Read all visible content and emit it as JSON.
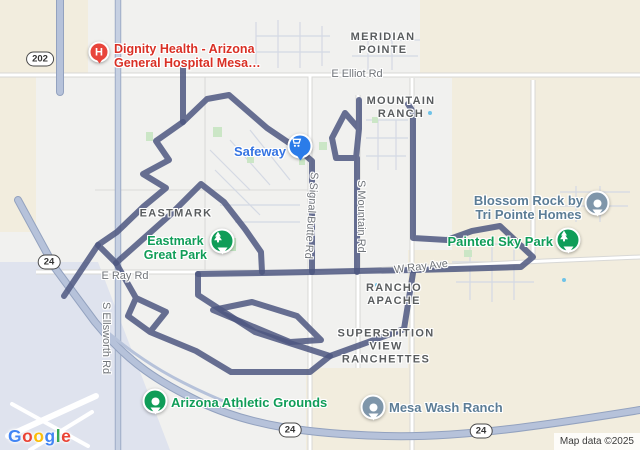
{
  "app": "google-maps-static-view",
  "attribution": "Map data ©2025",
  "hospital_pin_letter": "H",
  "areas": [
    {
      "id": "meridian-pointe",
      "lines": [
        "MERIDIAN",
        "POINTE"
      ]
    },
    {
      "id": "mountain-ranch",
      "lines": [
        "MOUNTAIN",
        "RANCH"
      ]
    },
    {
      "id": "eastmark",
      "lines": [
        "EASTMARK"
      ]
    },
    {
      "id": "rancho-apache",
      "lines": [
        "RANCHO",
        "APACHE"
      ]
    },
    {
      "id": "superstition-view-ranchettes",
      "lines": [
        "SUPERSTITION",
        "VIEW",
        "RANCHETTES"
      ]
    }
  ],
  "roads": [
    {
      "id": "e-elliot-rd",
      "label": "E Elliot Rd"
    },
    {
      "id": "e-ray-rd",
      "label": "E Ray Rd"
    },
    {
      "id": "w-ray-ave",
      "label": "W Ray Ave"
    },
    {
      "id": "s-ellsworth-rd",
      "label": "S Ellsworth Rd"
    },
    {
      "id": "s-signal-butte-rd",
      "label": "S Signal Butte Rd"
    },
    {
      "id": "s-mountain-rd",
      "label": "S Mountain Rd"
    }
  ],
  "shields": [
    {
      "label": "202"
    },
    {
      "label": "24"
    },
    {
      "label": "24"
    },
    {
      "label": "24"
    }
  ],
  "pois": [
    {
      "id": "dignity-health",
      "type": "hospital",
      "icon": "hospital-h-icon",
      "lines": [
        "Dignity Health - Arizona",
        "General Hospital Mesa…"
      ]
    },
    {
      "id": "safeway",
      "type": "grocery",
      "icon": "cart-icon",
      "lines": [
        "Safeway"
      ]
    },
    {
      "id": "eastmark-great-park",
      "type": "park",
      "icon": "tree-icon",
      "lines": [
        "Eastmark",
        "Great Park"
      ]
    },
    {
      "id": "blossom-rock",
      "type": "business",
      "icon": "dot-icon",
      "lines": [
        "Blossom Rock by",
        "Tri Pointe Homes"
      ]
    },
    {
      "id": "painted-sky-park",
      "type": "park",
      "icon": "tree-icon",
      "lines": [
        "Painted Sky Park"
      ]
    },
    {
      "id": "arizona-athletic-grounds",
      "type": "sports",
      "icon": "dot-icon",
      "lines": [
        "Arizona Athletic Grounds"
      ]
    },
    {
      "id": "mesa-wash-ranch",
      "type": "place",
      "icon": "dot-icon",
      "lines": [
        "Mesa Wash Ranch"
      ]
    }
  ],
  "logo": {
    "letters": [
      {
        "ch": "G",
        "style": "color:#4285F4"
      },
      {
        "ch": "o",
        "style": "color:#EA4335"
      },
      {
        "ch": "o",
        "style": "color:#FBBC05"
      },
      {
        "ch": "g",
        "style": "color:#4285F4"
      },
      {
        "ch": "l",
        "style": "color:#34A853"
      },
      {
        "ch": "e",
        "style": "color:#EA4335"
      }
    ]
  },
  "colors": {
    "route": "#4d5780",
    "freeway": "#b6c2da",
    "map_background": "#f1f1ef",
    "undeveloped_beige": "#f2edde",
    "airport_area": "#dfe3ee",
    "poi_green": "#0f9d58",
    "poi_blue": "#2b7ce9",
    "poi_red": "#e8453c",
    "poi_slate": "#7f96aa",
    "label_red": "#d93025",
    "label_green": "#109d58",
    "label_blue": "#3574e2",
    "label_slate": "#5c7d96"
  }
}
